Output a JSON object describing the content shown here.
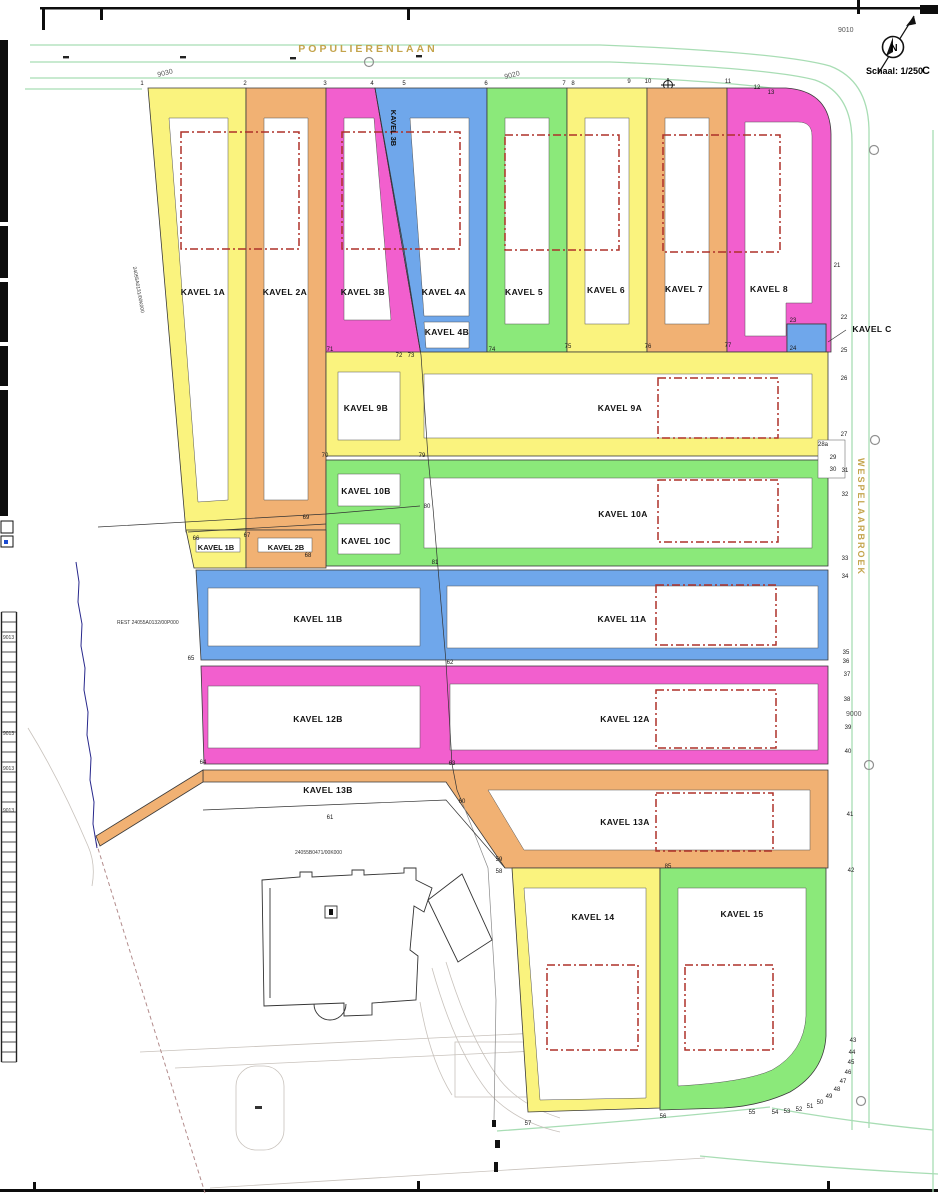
{
  "meta": {
    "scale_label": "Schaal: 1/250",
    "north_label": "N",
    "corner_mark": "C"
  },
  "streets": {
    "top": "POPULIERENLAAN",
    "right": "WESPELAARBROEK"
  },
  "palette": {
    "yellow": "#FAF37E",
    "orange": "#F1B173",
    "magenta": "#F25FCE",
    "blue": "#6FA7EB",
    "green": "#8BE97A",
    "roadline": "#A8DDB4",
    "street": "#C4A44C",
    "envelope": "#AE3129"
  },
  "grid": [
    {
      "text": "9030"
    },
    {
      "text": "9020"
    },
    {
      "text": "9010"
    },
    {
      "text": "9000"
    }
  ],
  "cadastral": {
    "west": "24055A0131/00K000",
    "rest": "REST 24055A0132/00P000",
    "building": "24055B0471/00K000",
    "adjacent": "9013"
  },
  "parcels": {
    "k1a": {
      "label": "KAVEL 1A"
    },
    "k2a": {
      "label": "KAVEL 2A"
    },
    "k3b": {
      "label": "KAVEL 3B"
    },
    "k4a": {
      "label": "KAVEL 4A"
    },
    "k4b": {
      "label": "KAVEL 4B"
    },
    "k5": {
      "label": "KAVEL 5"
    },
    "k6": {
      "label": "KAVEL 6"
    },
    "k7": {
      "label": "KAVEL 7"
    },
    "k8": {
      "label": "KAVEL 8"
    },
    "kc": {
      "label": "KAVEL C"
    },
    "k9b": {
      "label": "KAVEL 9B"
    },
    "k9a": {
      "label": "KAVEL 9A"
    },
    "k10b": {
      "label": "KAVEL 10B"
    },
    "k10a": {
      "label": "KAVEL 10A"
    },
    "k10c": {
      "label": "KAVEL 10C"
    },
    "k1b": {
      "label": "KAVEL 1B"
    },
    "k2b": {
      "label": "KAVEL 2B"
    },
    "k11b": {
      "label": "KAVEL 11B"
    },
    "k11a": {
      "label": "KAVEL 11A"
    },
    "k12b": {
      "label": "KAVEL 12B"
    },
    "k12a": {
      "label": "KAVEL 12A"
    },
    "k13b": {
      "label": "KAVEL 13B"
    },
    "k13a": {
      "label": "KAVEL 13A"
    },
    "k14": {
      "label": "KAVEL 14"
    },
    "k15": {
      "label": "KAVEL 15"
    }
  },
  "markers": [
    {
      "n": "1",
      "x": 142,
      "y": 85
    },
    {
      "n": "2",
      "x": 245,
      "y": 85
    },
    {
      "n": "3",
      "x": 325,
      "y": 85
    },
    {
      "n": "4",
      "x": 372,
      "y": 85
    },
    {
      "n": "5",
      "x": 404,
      "y": 85
    },
    {
      "n": "6",
      "x": 486,
      "y": 85
    },
    {
      "n": "7",
      "x": 564,
      "y": 85
    },
    {
      "n": "8",
      "x": 573,
      "y": 85
    },
    {
      "n": "9",
      "x": 629,
      "y": 83
    },
    {
      "n": "10",
      "x": 648,
      "y": 83
    },
    {
      "n": "11",
      "x": 728,
      "y": 83
    },
    {
      "n": "12",
      "x": 757,
      "y": 89
    },
    {
      "n": "13",
      "x": 771,
      "y": 94
    },
    {
      "n": "21",
      "x": 837,
      "y": 267
    },
    {
      "n": "22",
      "x": 844,
      "y": 319
    },
    {
      "n": "23",
      "x": 793,
      "y": 322
    },
    {
      "n": "24",
      "x": 793,
      "y": 350
    },
    {
      "n": "25",
      "x": 844,
      "y": 352
    },
    {
      "n": "26",
      "x": 844,
      "y": 380
    },
    {
      "n": "27",
      "x": 844,
      "y": 436
    },
    {
      "n": "28a",
      "x": 823,
      "y": 446
    },
    {
      "n": "29",
      "x": 833,
      "y": 459
    },
    {
      "n": "30",
      "x": 833,
      "y": 471
    },
    {
      "n": "31",
      "x": 845,
      "y": 472
    },
    {
      "n": "32",
      "x": 845,
      "y": 496
    },
    {
      "n": "33",
      "x": 845,
      "y": 560
    },
    {
      "n": "34",
      "x": 845,
      "y": 578
    },
    {
      "n": "35",
      "x": 846,
      "y": 654
    },
    {
      "n": "36",
      "x": 846,
      "y": 663
    },
    {
      "n": "37",
      "x": 847,
      "y": 676
    },
    {
      "n": "38",
      "x": 847,
      "y": 701
    },
    {
      "n": "39",
      "x": 848,
      "y": 729
    },
    {
      "n": "40",
      "x": 848,
      "y": 753
    },
    {
      "n": "41",
      "x": 850,
      "y": 816
    },
    {
      "n": "42",
      "x": 851,
      "y": 872
    },
    {
      "n": "43",
      "x": 853,
      "y": 1042
    },
    {
      "n": "44",
      "x": 852,
      "y": 1054
    },
    {
      "n": "45",
      "x": 851,
      "y": 1064
    },
    {
      "n": "46",
      "x": 848,
      "y": 1074
    },
    {
      "n": "47",
      "x": 843,
      "y": 1083
    },
    {
      "n": "48",
      "x": 837,
      "y": 1091
    },
    {
      "n": "49",
      "x": 829,
      "y": 1098
    },
    {
      "n": "50",
      "x": 820,
      "y": 1104
    },
    {
      "n": "51",
      "x": 810,
      "y": 1108
    },
    {
      "n": "52",
      "x": 799,
      "y": 1111
    },
    {
      "n": "53",
      "x": 787,
      "y": 1113
    },
    {
      "n": "54",
      "x": 775,
      "y": 1114
    },
    {
      "n": "55",
      "x": 752,
      "y": 1114
    },
    {
      "n": "56",
      "x": 663,
      "y": 1118
    },
    {
      "n": "57",
      "x": 528,
      "y": 1125
    },
    {
      "n": "58",
      "x": 499,
      "y": 873
    },
    {
      "n": "59",
      "x": 499,
      "y": 861
    },
    {
      "n": "60",
      "x": 462,
      "y": 803
    },
    {
      "n": "61",
      "x": 330,
      "y": 819
    },
    {
      "n": "62",
      "x": 450,
      "y": 664
    },
    {
      "n": "63",
      "x": 452,
      "y": 765
    },
    {
      "n": "64",
      "x": 203,
      "y": 764
    },
    {
      "n": "65",
      "x": 191,
      "y": 660
    },
    {
      "n": "66",
      "x": 196,
      "y": 540
    },
    {
      "n": "67",
      "x": 247,
      "y": 537
    },
    {
      "n": "68",
      "x": 308,
      "y": 557
    },
    {
      "n": "69",
      "x": 306,
      "y": 519
    },
    {
      "n": "70",
      "x": 325,
      "y": 457
    },
    {
      "n": "71",
      "x": 330,
      "y": 351
    },
    {
      "n": "72",
      "x": 399,
      "y": 357
    },
    {
      "n": "73",
      "x": 411,
      "y": 357
    },
    {
      "n": "74",
      "x": 492,
      "y": 351
    },
    {
      "n": "75",
      "x": 568,
      "y": 348
    },
    {
      "n": "76",
      "x": 648,
      "y": 348
    },
    {
      "n": "77",
      "x": 728,
      "y": 347
    },
    {
      "n": "79",
      "x": 422,
      "y": 457
    },
    {
      "n": "80",
      "x": 427,
      "y": 508
    },
    {
      "n": "81",
      "x": 435,
      "y": 564
    },
    {
      "n": "85",
      "x": 668,
      "y": 868
    }
  ]
}
